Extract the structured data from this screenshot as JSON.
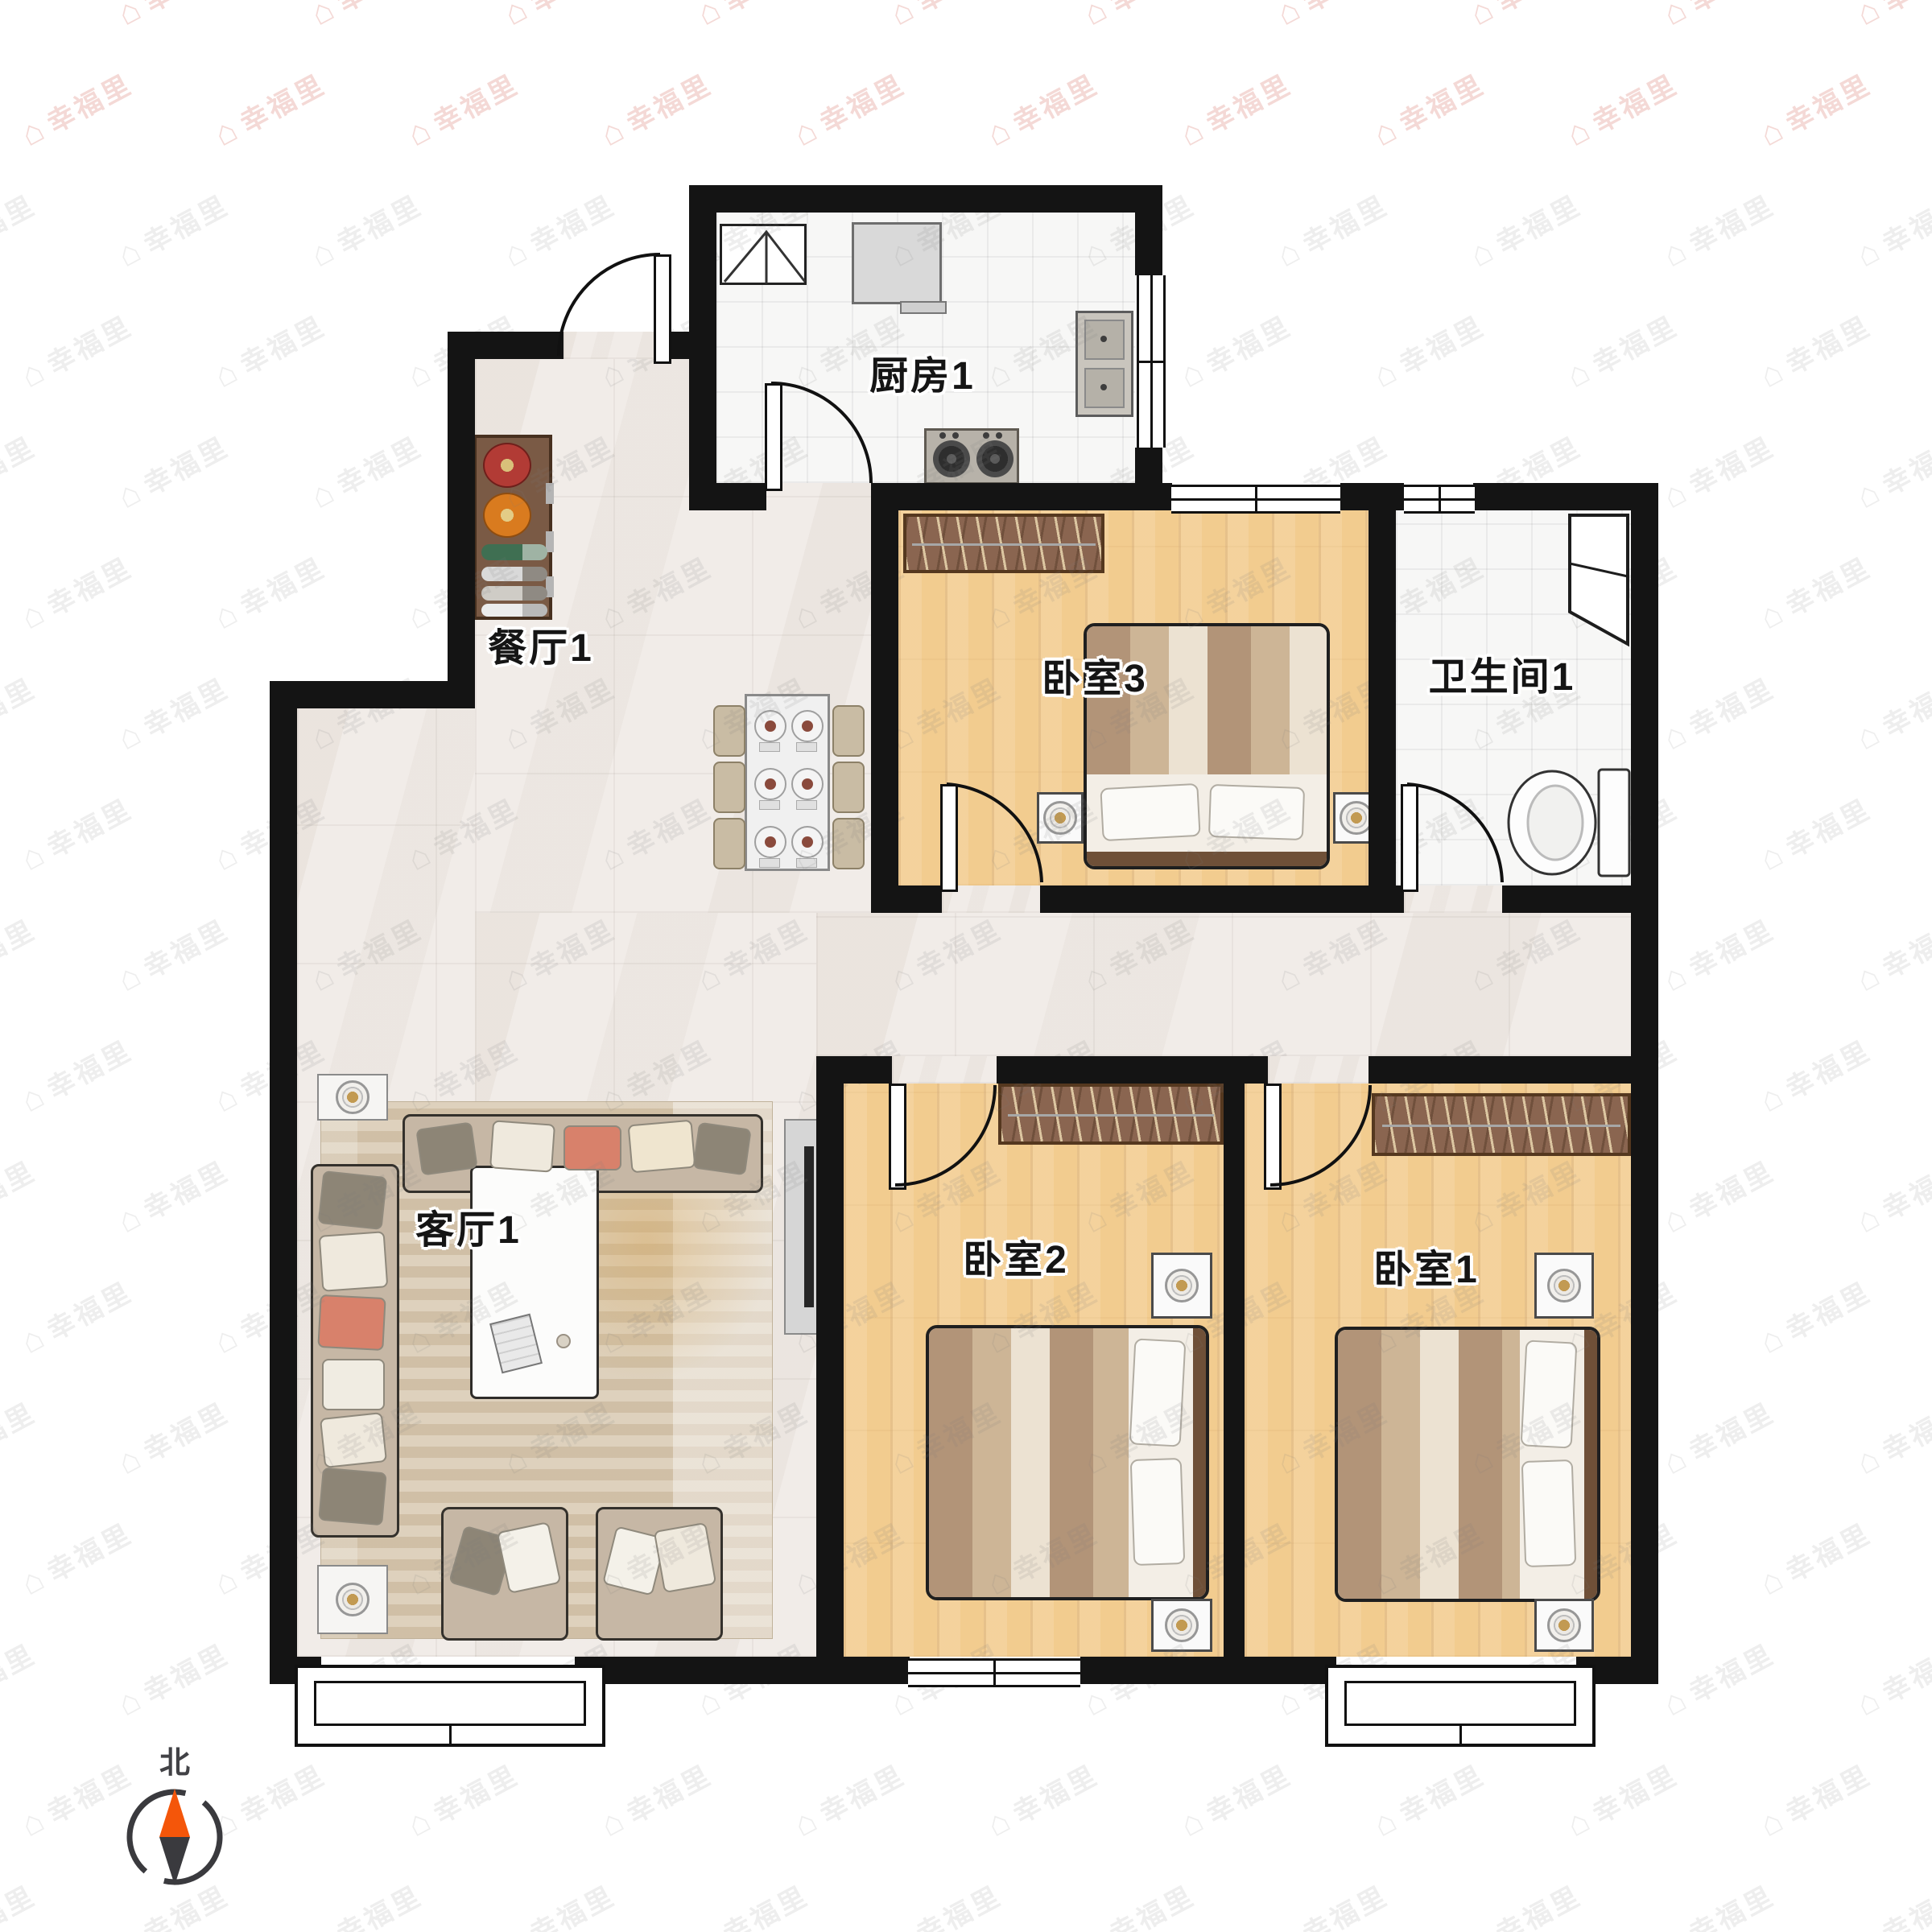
{
  "watermark": {
    "text": "幸福里",
    "icon": "house-icon"
  },
  "rooms": {
    "kitchen": {
      "label": "厨房1"
    },
    "dining": {
      "label": "餐厅1"
    },
    "bedroom3": {
      "label": "卧室3"
    },
    "bathroom": {
      "label": "卫生间1"
    },
    "living": {
      "label": "客厅1"
    },
    "bedroom2": {
      "label": "卧室2"
    },
    "bedroom1": {
      "label": "卧室1"
    }
  },
  "compass": {
    "label": "北",
    "north_color": "#f4560a",
    "south_color": "#3a3a3e"
  },
  "colors": {
    "wall": "#141414",
    "wood_floor": "#f2cc8f",
    "marble_floor": "#f1ece8",
    "tile_floor": "#f7f7f6",
    "wardrobe": "#8a6550",
    "bed_frame": "#6f5038",
    "sofa": "#c6b7a5",
    "accent_red": "#b23b35",
    "accent_orange": "#d97b1f"
  }
}
